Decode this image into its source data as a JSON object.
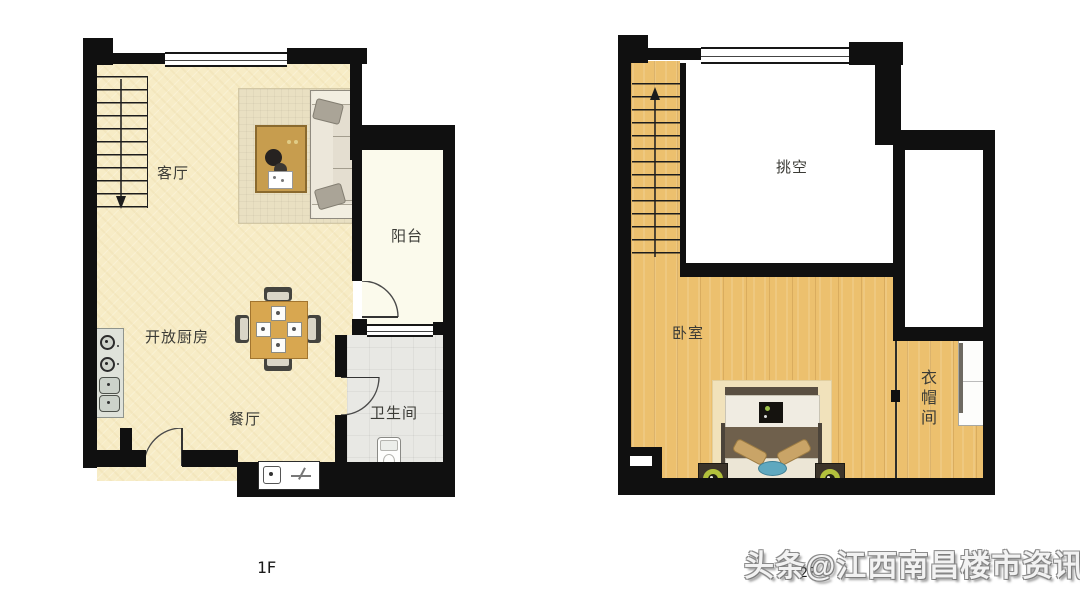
{
  "plans": {
    "floor1": {
      "label": "1F",
      "rooms": [
        {
          "name": "living-room",
          "label": "客厅"
        },
        {
          "name": "balcony",
          "label": "阳台"
        },
        {
          "name": "open-kitchen",
          "label": "开放厨房"
        },
        {
          "name": "dining-room",
          "label": "餐厅"
        },
        {
          "name": "bathroom",
          "label": "卫生间"
        }
      ]
    },
    "floor2": {
      "label": "2F",
      "rooms": [
        {
          "name": "void-double-height",
          "label": "挑空"
        },
        {
          "name": "bedroom",
          "label": "卧室"
        },
        {
          "name": "cloakroom",
          "label": "衣帽间"
        }
      ]
    }
  },
  "watermark": {
    "text": "头条@江西南昌楼市资讯"
  },
  "colors": {
    "wall": "#101010",
    "floor_1f_cream": "#f7ecc6",
    "balcony_floor": "#fbfaec",
    "bathroom_tile": "#e8e8e4",
    "wood_floor": "#ecc06e",
    "lamp_accent": "#b2c13c",
    "bed_blanket": "#6f604c",
    "bed_pillow_blue": "#5fa8bf",
    "watermark_text": "#f2f2f2"
  }
}
